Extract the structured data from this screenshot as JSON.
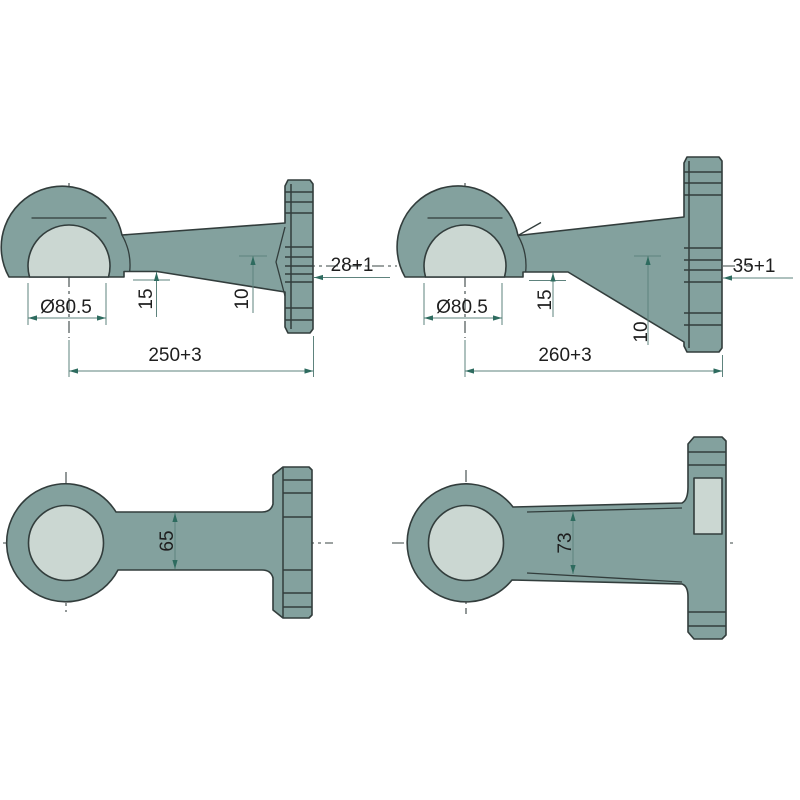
{
  "drawing": {
    "title": "lower-link-ball-end-technical-drawing",
    "colors": {
      "body_fill": "#83a19e",
      "bore_fill": "#cbd7d2",
      "outline": "#323d3c",
      "dimension_line": "#5e837d",
      "arrow": "#2e6b5f",
      "text": "#1e1e1e",
      "background": "#ffffff"
    },
    "views": {
      "top_left": {
        "name": "side-view-variant-a",
        "labels": {
          "diameter": "Ø80.5",
          "height_15": "15",
          "height_10": "10",
          "flange_thickness": "28+1",
          "length": "250+3"
        }
      },
      "top_right": {
        "name": "side-view-variant-b",
        "labels": {
          "diameter": "Ø80.5",
          "height_15": "15",
          "height_10": "10",
          "flange_thickness": "35+1",
          "length": "260+3"
        }
      },
      "bottom_left": {
        "name": "plan-view-variant-a",
        "labels": {
          "shaft_width": "65"
        }
      },
      "bottom_right": {
        "name": "plan-view-variant-b",
        "labels": {
          "shaft_width": "73"
        }
      }
    }
  }
}
